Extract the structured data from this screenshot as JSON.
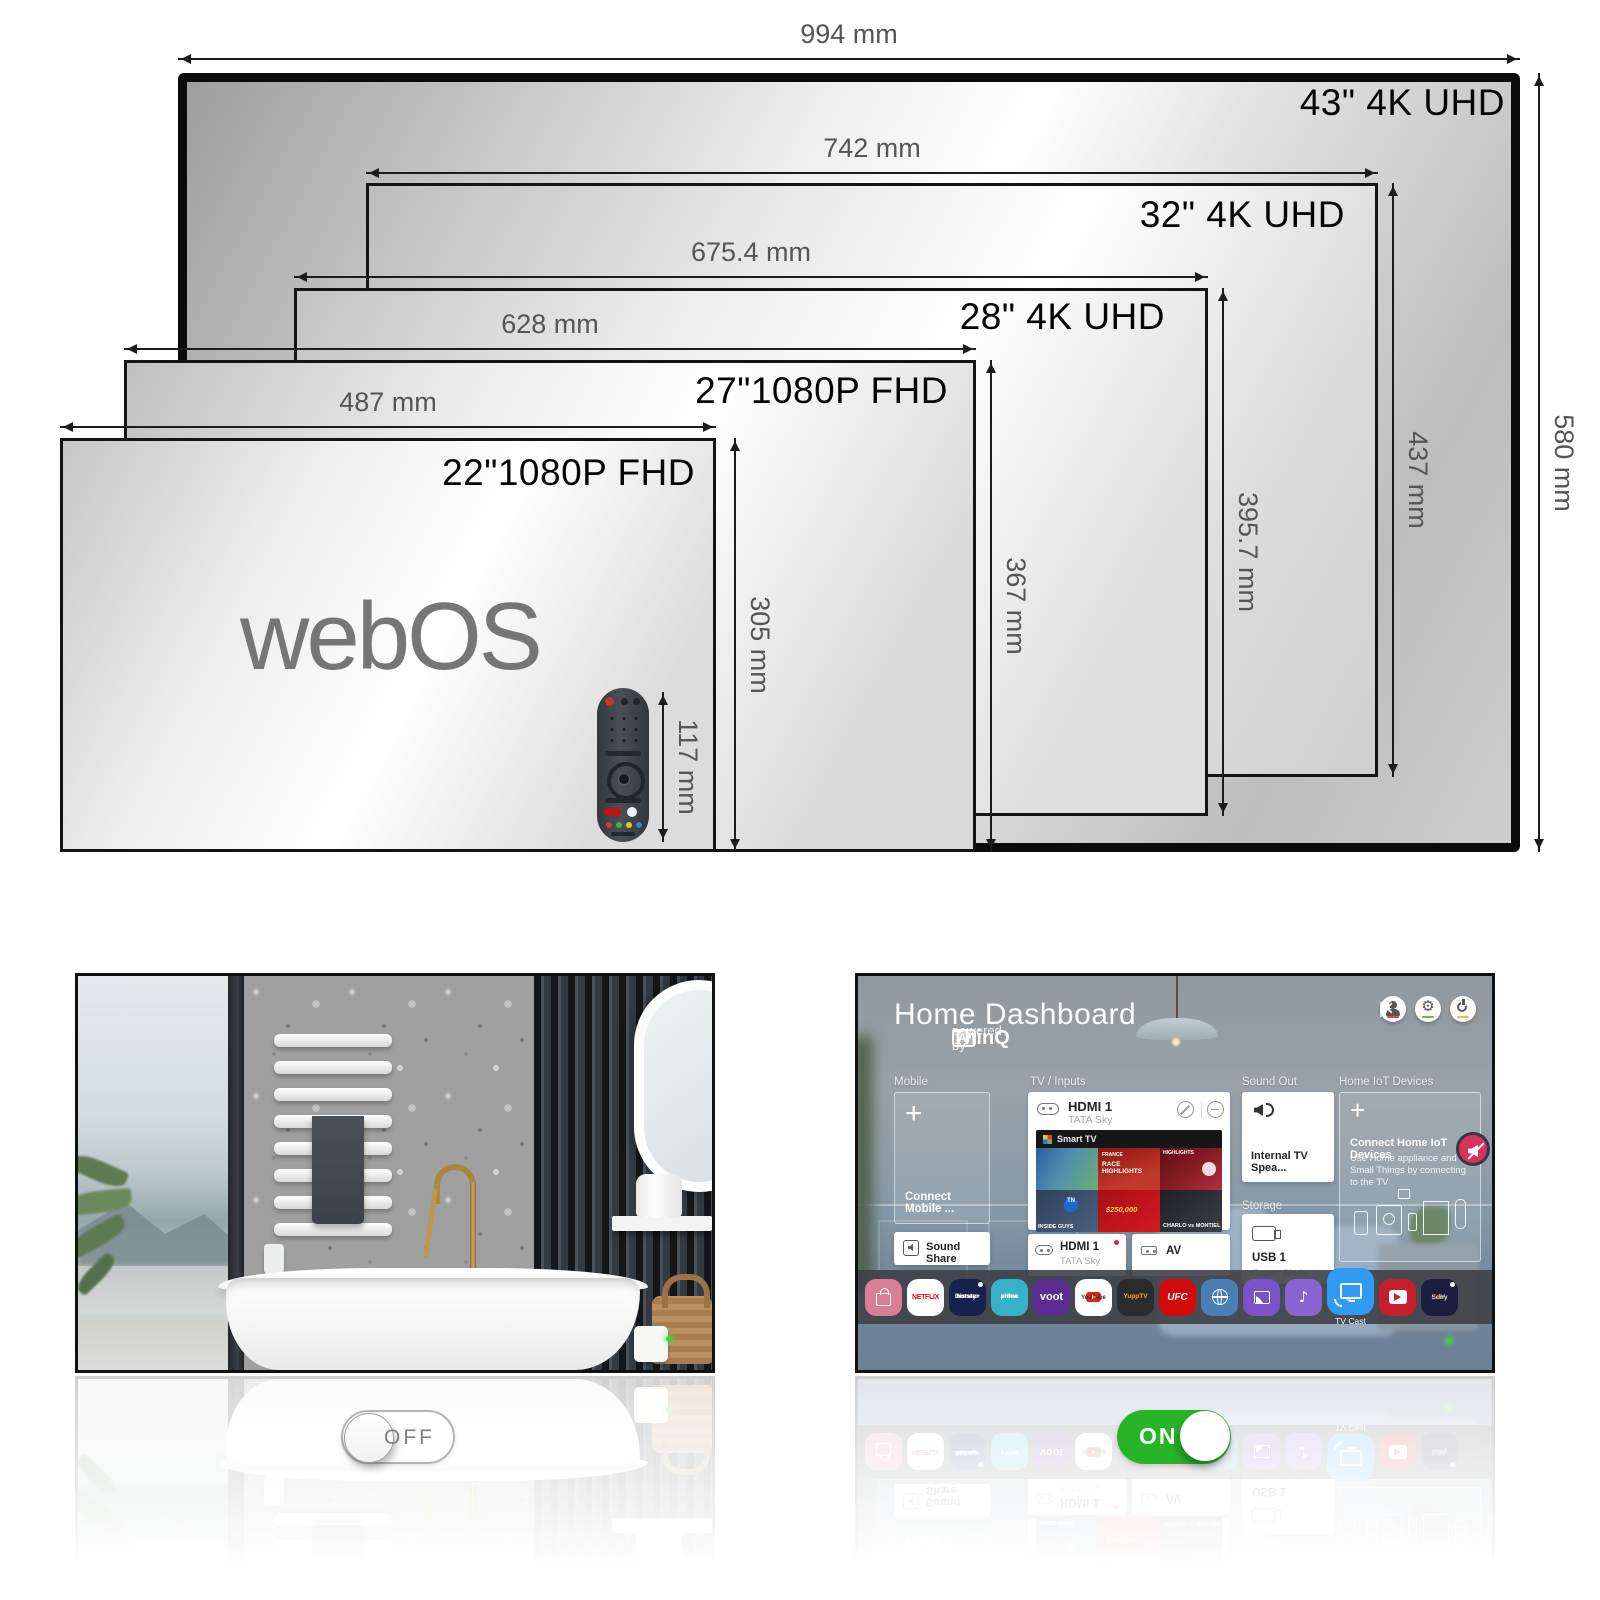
{
  "diagram": {
    "screens": [
      {
        "name": "43-inch",
        "label": "43\" 4K UHD",
        "width_label": "994 mm",
        "height_label": "580 mm"
      },
      {
        "name": "32-inch",
        "label": "32\" 4K UHD",
        "width_label": "742 mm",
        "height_label": "437 mm"
      },
      {
        "name": "28-inch",
        "label": "28\" 4K UHD",
        "width_label": "675.4 mm",
        "height_label": "395.7 mm"
      },
      {
        "name": "27-inch",
        "label": "27\"1080P FHD",
        "width_label": "628 mm",
        "height_label": "367 mm"
      },
      {
        "name": "22-inch",
        "label": "22\"1080P FHD",
        "width_label": "487 mm",
        "height_label": "305 mm"
      }
    ],
    "logo_text": "webOS",
    "remote_height_label": "117 mm"
  },
  "mirror_panel": {
    "toggle_label": "OFF"
  },
  "tv_panel": {
    "title": "Home Dashboard",
    "powered_by_prefix": "powered by",
    "powered_by_brand": "ThinQ",
    "powered_by_badge": "AI",
    "section_labels": {
      "mobile": "Mobile",
      "tv_inputs": "TV / Inputs",
      "sound_out": "Sound Out",
      "home_iot": "Home IoT Devices",
      "storage": "Storage"
    },
    "mobile_card_label": "Connect Mobile ...",
    "sound_share_label": "Sound Share",
    "hdmi_main": {
      "title": "HDMI 1",
      "subtitle": "TATA Sky"
    },
    "smart_tv_label": "Smart TV",
    "tiles": {
      "t2a": "FRANCE",
      "t2b": "RACE HIGHLIGHTS",
      "t3": "HIGHLIGHTS",
      "t4": "INSIDE GUYS",
      "tn": "TN",
      "t5": "$250,000",
      "t6": "CHARLO vs MONTIEL"
    },
    "hdmi_small": {
      "title": "HDMI 1",
      "subtitle": "TATA Sky"
    },
    "av_label": "AV",
    "sound_out_card": "Internal TV Spea...",
    "storage_card": {
      "title": "USB 1",
      "subtitle": "Cruzer Blade"
    },
    "iot": {
      "title": "Connect Home IoT Devices",
      "desc": "Use Home appliance and Small Things by connecting to the TV"
    },
    "dock": [
      {
        "name": "lg-content-store"
      },
      {
        "name": "netflix",
        "label": "NETFLIX"
      },
      {
        "name": "disney-plus-hotstar",
        "label": "Disney+",
        "label2": "hotstar"
      },
      {
        "name": "prime-video",
        "label": "prime",
        "label2": "video"
      },
      {
        "name": "voot",
        "label": "voot"
      },
      {
        "name": "youtube",
        "label": "YouTube"
      },
      {
        "name": "yupptv",
        "label": "YuppTV"
      },
      {
        "name": "ufc",
        "label": "UFC"
      },
      {
        "name": "web-browser"
      },
      {
        "name": "gallery"
      },
      {
        "name": "music"
      },
      {
        "name": "tv-cast",
        "label": "TV Cast"
      },
      {
        "name": "shemaroo"
      },
      {
        "name": "sony-liv",
        "label": "Sony",
        "label2": "LIV"
      }
    ],
    "toggle_label": "ON"
  },
  "icons": {
    "plus": "+",
    "close": "×",
    "gear": "⚙",
    "music_note": "♪"
  },
  "colors": {
    "toggle_on_green": "#27b427",
    "tv_cast_blue": "#2f9bf4",
    "netflix_red": "#e50914",
    "ufc_red": "#d20a0a",
    "mute_pink": "#d9325e",
    "led_green": "#3bd23b",
    "voot_purple": "#5c2d91",
    "prime_teal": "#37b2c9",
    "store_pink": "#d87e96",
    "hotstar_navy": "#17214d",
    "browser_blue": "#4a7fb5",
    "gallery_purple": "#7b52c7",
    "music_purple": "#8a63d2",
    "shemaroo_red": "#c51f2e",
    "sonyliv_navy": "#1d1d40"
  }
}
